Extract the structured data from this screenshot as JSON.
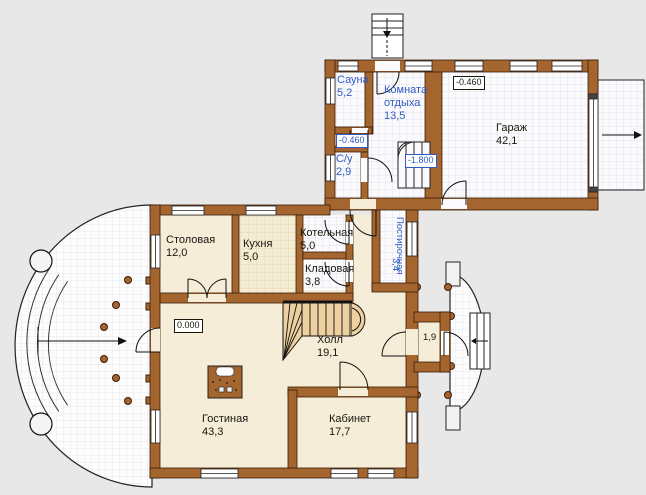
{
  "colors": {
    "background": "#e8e8e8",
    "wall_brown": "#a5652f",
    "wall_outline": "#3a1d08",
    "floor_cream": "#f6edd8",
    "tile_white": "#fbfbfd",
    "stair_tan": "#ecd0a0",
    "label_black": "#17170e",
    "label_blue": "#2f5bc4"
  },
  "rooms": [
    {
      "id": "sauna",
      "name": "Сауна",
      "area": "5,2"
    },
    {
      "id": "rest",
      "name": "Комната отдыха",
      "area": "13,5"
    },
    {
      "id": "garage",
      "name": "Гараж",
      "area": "42,1"
    },
    {
      "id": "wc",
      "name": "С/у",
      "area": "2,9"
    },
    {
      "id": "dining",
      "name": "Столовая",
      "area": "12,0"
    },
    {
      "id": "kitchen",
      "name": "Кухня",
      "area": "5,0"
    },
    {
      "id": "boiler",
      "name": "Котельная",
      "area": "5,0"
    },
    {
      "id": "pantry",
      "name": "Кладовая",
      "area": "3,8"
    },
    {
      "id": "laundry",
      "name": "Постирочная",
      "area": "3,4"
    },
    {
      "id": "hall",
      "name": "Холл",
      "area": "19,1"
    },
    {
      "id": "living",
      "name": "Гостиная",
      "area": "43,3"
    },
    {
      "id": "study",
      "name": "Кабинет",
      "area": "17,7"
    }
  ],
  "marks": [
    {
      "id": "garage-elevation",
      "value": "-0.460"
    },
    {
      "id": "sauna-elevation",
      "value": "-0.460"
    },
    {
      "id": "stair-elevation",
      "value": "-1.800"
    },
    {
      "id": "zero-elevation",
      "value": "0.000"
    },
    {
      "id": "vestibule-area",
      "value": "1,9"
    }
  ]
}
